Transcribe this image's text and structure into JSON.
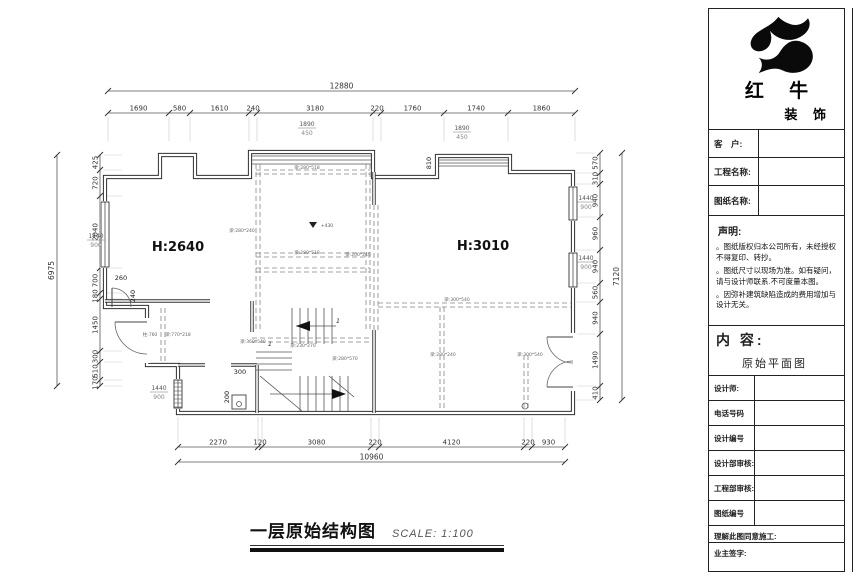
{
  "caption": {
    "title": "一层原始结构图",
    "scale": "SCALE: 1:100"
  },
  "title_block": {
    "brand": {
      "name_top": "红 牛",
      "name_bottom": "装 饰",
      "logo": "bull-logo"
    },
    "fields": [
      {
        "label": "客　户:"
      },
      {
        "label": "工程名称:"
      },
      {
        "label": "图纸名称:"
      }
    ],
    "declaration": {
      "heading": "声明:",
      "items": [
        "。图纸版权归本公司所有，未经授权不得复印、转抄。",
        "。图纸尺寸以现场为准。如有疑问，请与设计师联系.不可度量本图。",
        "。因弥补建筑缺陷造成的费用增加与设计无关。"
      ]
    },
    "content": {
      "heading": "内 容:",
      "value": "原始平面图"
    },
    "form_rows": [
      "设计师:",
      "电话号码",
      "设计编号",
      "设计部审核:",
      "工程部审核:",
      "图纸编号"
    ],
    "footer_rows": [
      "理解此图同意施工:",
      "业主签字:"
    ]
  },
  "plan": {
    "rooms": [
      {
        "x": 178,
        "y": 251,
        "t": "H:2640"
      },
      {
        "x": 483,
        "y": 250,
        "t": "H:3010"
      }
    ],
    "walls": {
      "outer": "M105,177 H160 V155 H195 V177 H250 V152 H373 V177 H437 V156 H510 V172 H573 V413 H178 V365 H147 V307 H105 Z",
      "inner": [
        "M105,301 H210",
        "M252,301 V332",
        "M178,365 H205",
        "M231,365 H257",
        "M257,365 V413",
        "M374,172 V205",
        "M374,330 V413"
      ]
    },
    "bay_lines": [
      [
        252,
        156,
        371,
        156
      ],
      [
        252,
        160,
        371,
        160
      ],
      [
        252,
        164,
        371,
        164
      ],
      [
        439,
        160,
        508,
        160
      ],
      [
        439,
        163,
        508,
        163
      ],
      [
        439,
        166,
        508,
        166
      ]
    ],
    "dashed": [
      [
        256,
        164,
        256,
        332
      ],
      [
        260,
        164,
        260,
        332
      ],
      [
        366,
        164,
        366,
        332
      ],
      [
        370,
        164,
        370,
        332
      ],
      [
        374,
        205,
        374,
        330
      ],
      [
        378,
        205,
        378,
        330
      ],
      [
        161,
        308,
        161,
        364
      ],
      [
        165,
        308,
        165,
        364
      ],
      [
        256,
        170,
        370,
        170
      ],
      [
        256,
        174,
        370,
        174
      ],
      [
        256,
        253,
        370,
        253
      ],
      [
        256,
        257,
        370,
        257
      ],
      [
        256,
        268,
        370,
        268
      ],
      [
        256,
        272,
        370,
        272
      ],
      [
        378,
        303,
        571,
        303
      ],
      [
        378,
        307,
        571,
        307
      ],
      [
        440,
        307,
        440,
        411
      ],
      [
        444,
        307,
        444,
        411
      ],
      [
        524,
        355,
        524,
        411
      ],
      [
        528,
        355,
        528,
        411
      ],
      [
        252,
        338,
        372,
        338
      ],
      [
        252,
        342,
        372,
        342
      ]
    ],
    "windows": [
      {
        "x": 101,
        "y": 202,
        "w": 8,
        "h": 65
      },
      {
        "x": 569,
        "y": 187,
        "w": 8,
        "h": 33
      },
      {
        "x": 569,
        "y": 253,
        "w": 8,
        "h": 34
      },
      {
        "x": 174,
        "y": 380,
        "w": 8,
        "h": 28,
        "hatch": true
      }
    ],
    "doors": {
      "erase": [
        [
          143,
          318,
          8,
          45
        ],
        [
          569,
          333,
          8,
          58
        ]
      ],
      "leaves": [
        "M147,322 L115,322",
        "M112,288 L112,307",
        "M573,337 L547,337",
        "M573,387 L547,387"
      ],
      "arcs": [
        "M115,322 A32,32 0 0 0 147,354",
        "M112,288 A19,19 0 0 1 131,307",
        "M547,337 A26,26 0 0 0 573,363",
        "M547,387 A26,26 0 0 1 573,361"
      ]
    },
    "stairs": {
      "lines": [
        [
          292,
          308,
          292,
          344
        ],
        [
          300,
          308,
          300,
          344
        ],
        [
          308,
          308,
          308,
          344
        ],
        [
          316,
          308,
          316,
          344
        ],
        [
          324,
          308,
          324,
          344
        ],
        [
          332,
          308,
          332,
          344
        ],
        [
          256,
          352,
          292,
          352
        ],
        [
          256,
          358,
          292,
          358
        ],
        [
          256,
          364,
          292,
          364
        ],
        [
          256,
          370,
          292,
          370
        ],
        [
          300,
          376,
          300,
          411
        ],
        [
          308,
          376,
          308,
          411
        ],
        [
          316,
          376,
          316,
          411
        ],
        [
          324,
          376,
          324,
          411
        ],
        [
          332,
          376,
          332,
          411
        ],
        [
          340,
          376,
          340,
          411
        ],
        [
          348,
          376,
          348,
          411
        ],
        [
          260,
          376,
          302,
          411
        ],
        [
          329,
          376,
          354,
          397
        ],
        [
          296,
          326,
          336,
          326
        ],
        [
          270,
          394,
          344,
          394
        ]
      ],
      "arrows": [
        [
          296,
          326,
          310,
          321,
          310,
          331
        ],
        [
          346,
          394,
          332,
          389,
          332,
          399
        ]
      ],
      "column": {
        "x": 232,
        "y": 395,
        "w": 14,
        "h": 14
      }
    },
    "circles": [
      [
        239,
        404,
        2.5
      ],
      [
        525,
        406,
        3
      ]
    ],
    "dims": {
      "chains": [
        {
          "dir": "h",
          "pos": 113,
          "stub": 28,
          "ticks": [
            108,
            169,
            190,
            249,
            257,
            373,
            381,
            444,
            508,
            575
          ],
          "values": [
            "1690",
            "580",
            "1610",
            "240",
            "3180",
            "220",
            "1760",
            "1740",
            "1860"
          ]
        },
        {
          "dir": "h",
          "pos": 447,
          "stub": -30,
          "ticks": [
            178,
            258,
            262,
            371,
            379,
            524,
            532,
            565
          ],
          "values": [
            "2270",
            "120",
            "3080",
            "220",
            "4120",
            "220",
            "930"
          ]
        },
        {
          "dir": "v",
          "pos": 100,
          "stub": 22,
          "ticks": [
            155,
            170,
            196,
            268,
            293,
            299,
            351,
            362,
            380,
            386
          ],
          "values": [
            "425",
            "720",
            "2040",
            "700",
            "180",
            "1450",
            "300",
            "510",
            "170"
          ]
        },
        {
          "dir": "v",
          "pos": 600,
          "stub": -24,
          "ticks": [
            153,
            173,
            184,
            217,
            250,
            283,
            302,
            334,
            386,
            400
          ],
          "values": [
            "570",
            "310",
            "940",
            "960",
            "940",
            "560",
            "940",
            "1490",
            "410"
          ]
        }
      ],
      "totals": [
        {
          "dir": "h",
          "pos": 91,
          "a": 108,
          "b": 575,
          "v": "12880"
        },
        {
          "dir": "h",
          "pos": 462,
          "a": 178,
          "b": 565,
          "v": "10960"
        },
        {
          "dir": "v",
          "pos": 57,
          "a": 155,
          "b": 386,
          "v": "6975"
        },
        {
          "dir": "v",
          "pos": 622,
          "a": 153,
          "b": 400,
          "v": "7120"
        }
      ]
    },
    "labels": {
      "beams": [
        {
          "x": 307,
          "y": 169,
          "t": "梁:280*518"
        },
        {
          "x": 242,
          "y": 232,
          "t": "梁:280*240"
        },
        {
          "x": 307,
          "y": 254,
          "t": "梁:280*518"
        },
        {
          "x": 358,
          "y": 256,
          "t": "梁:200*240"
        },
        {
          "x": 457,
          "y": 301,
          "t": "梁:300*540"
        },
        {
          "x": 443,
          "y": 356,
          "t": "梁:280*240"
        },
        {
          "x": 530,
          "y": 356,
          "t": "梁:300*540"
        },
        {
          "x": 150,
          "y": 336,
          "t": "柱:760"
        },
        {
          "x": 178,
          "y": 336,
          "t": "梁:770*218"
        },
        {
          "x": 253,
          "y": 343,
          "t": "梁:360*540"
        },
        {
          "x": 303,
          "y": 347,
          "t": "梁:230*270"
        },
        {
          "x": 345,
          "y": 360,
          "t": "梁:280*570"
        }
      ],
      "fracs": [
        {
          "x": 307,
          "y": 126,
          "top": "1890",
          "bot": "450"
        },
        {
          "x": 462,
          "y": 130,
          "top": "1890",
          "bot": "450"
        },
        {
          "x": 96,
          "y": 238,
          "top": "1440",
          "bot": "900"
        },
        {
          "x": 159,
          "y": 390,
          "top": "1440",
          "bot": "900"
        },
        {
          "x": 586,
          "y": 200,
          "top": "1440",
          "bot": "900"
        },
        {
          "x": 586,
          "y": 260,
          "top": "1440",
          "bot": "900"
        }
      ],
      "small_dims": [
        {
          "x": 121,
          "y": 280,
          "t": "260"
        },
        {
          "x": 135,
          "y": 296,
          "t": "240",
          "rot": 1
        },
        {
          "x": 240,
          "y": 374,
          "t": "300"
        },
        {
          "x": 229,
          "y": 397,
          "t": "200",
          "rot": 1
        },
        {
          "x": 431,
          "y": 163,
          "t": "810",
          "rot": 1
        }
      ],
      "marks": [
        {
          "x": 338,
          "y": 323,
          "t": "1"
        },
        {
          "x": 270,
          "y": 346,
          "t": "1"
        }
      ],
      "level": {
        "x": 313,
        "y": 222,
        "t": "+430"
      }
    }
  }
}
